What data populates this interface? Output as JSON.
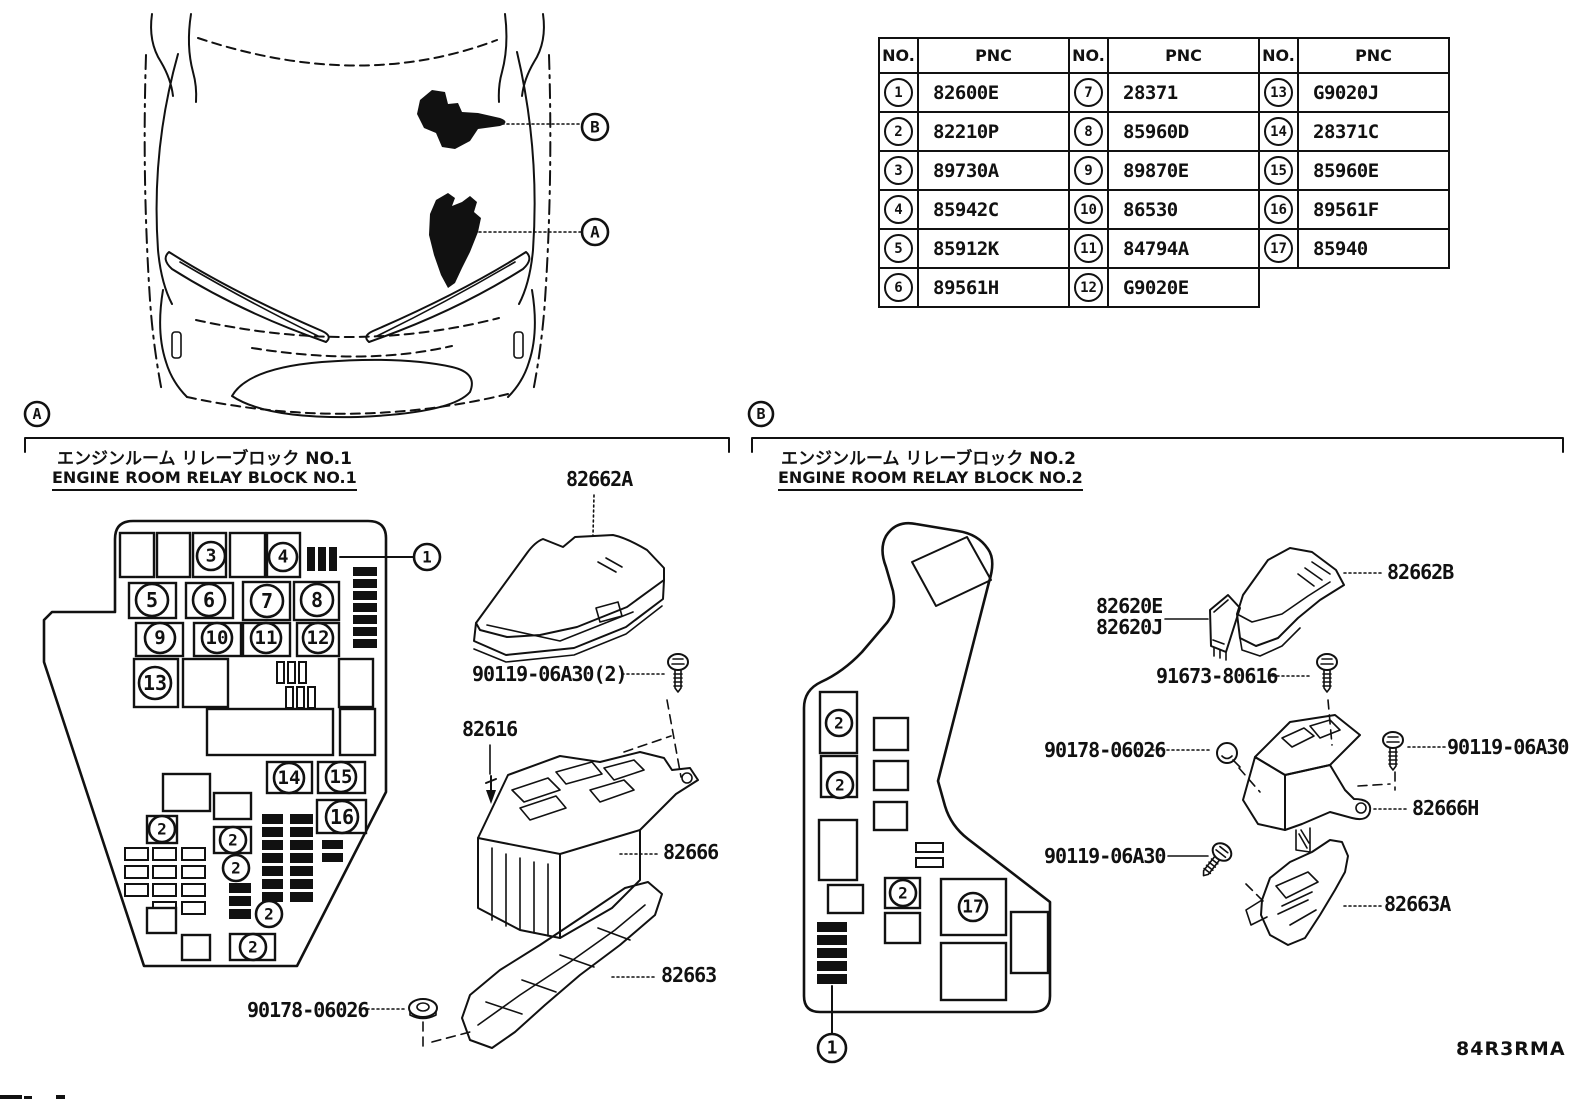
{
  "page": {
    "footer_code": "84R3RMA"
  },
  "pnc_table": {
    "no_header": "NO.",
    "pnc_header": "PNC",
    "groups": [
      {
        "rows": [
          [
            "1",
            "82600E"
          ],
          [
            "2",
            "82210P"
          ],
          [
            "3",
            "89730A"
          ],
          [
            "4",
            "85942C"
          ],
          [
            "5",
            "85912K"
          ],
          [
            "6",
            "89561H"
          ]
        ]
      },
      {
        "rows": [
          [
            "7",
            "28371"
          ],
          [
            "8",
            "85960D"
          ],
          [
            "9",
            "89870E"
          ],
          [
            "10",
            "86530"
          ],
          [
            "11",
            "84794A"
          ],
          [
            "12",
            "G9020E"
          ]
        ]
      },
      {
        "rows": [
          [
            "13",
            "G9020J"
          ],
          [
            "14",
            "28371C"
          ],
          [
            "15",
            "85960E"
          ],
          [
            "16",
            "89561F"
          ],
          [
            "17",
            "85940"
          ]
        ]
      }
    ]
  },
  "section_a": {
    "marker": "A",
    "title_jp": "エンジンルーム リレーブロック NO.1",
    "title_en": "ENGINE ROOM RELAY BLOCK NO.1",
    "labels": {
      "cover": "82662A",
      "bolt": "90119-06A30(2)",
      "screw": "82616",
      "block": "82666",
      "lower_cover": "82663",
      "nut": "90178-06026"
    }
  },
  "section_b": {
    "marker": "B",
    "title_jp": "エンジンルーム リレーブロック NO.2",
    "title_en": "ENGINE ROOM RELAY BLOCK NO.2",
    "labels": {
      "cover": "82662B",
      "relay_e": "82620E",
      "relay_j": "82620J",
      "screw": "91673-80616",
      "grommet": "90178-06026",
      "bolt_right": "90119-06A30",
      "block": "82666H",
      "bolt_left": "90119-06A30",
      "bracket": "82663A"
    }
  },
  "callouts": [
    {
      "label": "B",
      "x": 595,
      "y": 127,
      "r": 13
    },
    {
      "label": "A",
      "x": 595,
      "y": 232,
      "r": 13
    },
    {
      "label": "A",
      "x": 37,
      "y": 414,
      "r": 12
    },
    {
      "label": "B",
      "x": 761,
      "y": 414,
      "r": 12
    },
    {
      "label": "1",
      "x": 427,
      "y": 557,
      "r": 13
    },
    {
      "label": "3",
      "x": 211,
      "y": 556,
      "r": 14
    },
    {
      "label": "4",
      "x": 283,
      "y": 557,
      "r": 14
    },
    {
      "label": "5",
      "x": 152,
      "y": 600,
      "r": 16
    },
    {
      "label": "6",
      "x": 209,
      "y": 600,
      "r": 16
    },
    {
      "label": "7",
      "x": 267,
      "y": 601,
      "r": 16
    },
    {
      "label": "8",
      "x": 317,
      "y": 600,
      "r": 16
    },
    {
      "label": "9",
      "x": 160,
      "y": 638,
      "r": 15
    },
    {
      "label": "10",
      "x": 217,
      "y": 638,
      "r": 15
    },
    {
      "label": "11",
      "x": 266,
      "y": 638,
      "r": 15
    },
    {
      "label": "12",
      "x": 318,
      "y": 638,
      "r": 15
    },
    {
      "label": "13",
      "x": 155,
      "y": 683,
      "r": 16
    },
    {
      "label": "14",
      "x": 289,
      "y": 778,
      "r": 15
    },
    {
      "label": "15",
      "x": 341,
      "y": 777,
      "r": 15
    },
    {
      "label": "16",
      "x": 342,
      "y": 817,
      "r": 16
    },
    {
      "label": "2",
      "x": 162,
      "y": 829,
      "r": 13
    },
    {
      "label": "2",
      "x": 233,
      "y": 840,
      "r": 13
    },
    {
      "label": "2",
      "x": 236,
      "y": 868,
      "r": 13
    },
    {
      "label": "2",
      "x": 269,
      "y": 914,
      "r": 13
    },
    {
      "label": "2",
      "x": 253,
      "y": 947,
      "r": 13
    },
    {
      "label": "2",
      "x": 839,
      "y": 723,
      "r": 13
    },
    {
      "label": "2",
      "x": 840,
      "y": 785,
      "r": 13
    },
    {
      "label": "2",
      "x": 903,
      "y": 893,
      "r": 13
    },
    {
      "label": "17",
      "x": 973,
      "y": 907,
      "r": 14
    },
    {
      "label": "1",
      "x": 832,
      "y": 1048,
      "r": 14
    }
  ]
}
